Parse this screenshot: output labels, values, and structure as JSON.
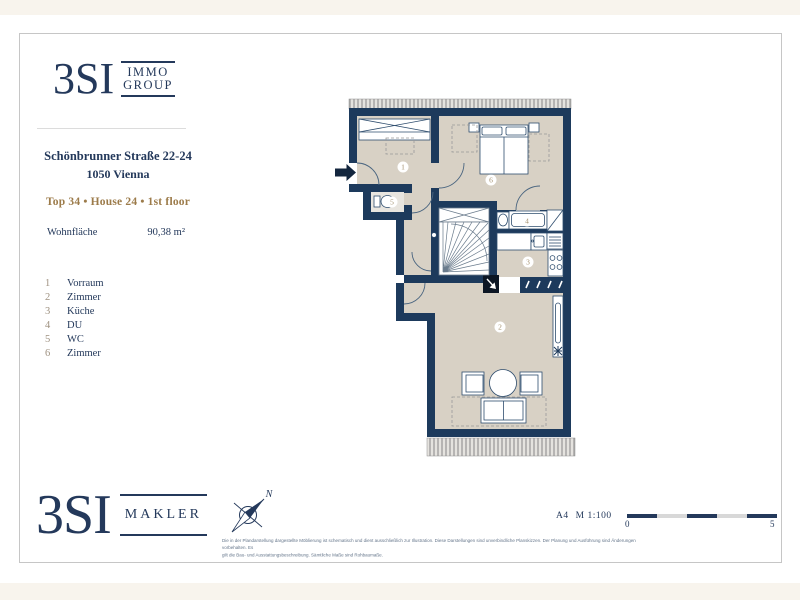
{
  "brand_top": {
    "name": "3SI",
    "tag_line1": "IMMO",
    "tag_line2": "GROUP"
  },
  "property": {
    "address_line1": "Schönbrunner Straße 22-24",
    "address_line2": "1050 Vienna",
    "unit_line": "Top 34 • House 24 • 1st floor",
    "area_label": "Wohnfläche",
    "area_value": "90,38 m²"
  },
  "legend": {
    "items": [
      {
        "num": "1",
        "label": "Vorraum"
      },
      {
        "num": "2",
        "label": "Zimmer"
      },
      {
        "num": "3",
        "label": "Küche"
      },
      {
        "num": "4",
        "label": "DU"
      },
      {
        "num": "5",
        "label": "WC"
      },
      {
        "num": "6",
        "label": "Zimmer"
      }
    ]
  },
  "plan": {
    "room_labels": [
      "1",
      "2",
      "3",
      "4",
      "5",
      "6"
    ],
    "colors": {
      "wall": "#1d3a5c",
      "floor": "#d8d1c5",
      "wet_floor": "#e8e5df"
    }
  },
  "brand_bottom": {
    "name": "3SI",
    "tag": "MAKLER"
  },
  "compass": {
    "north": "N"
  },
  "scale": {
    "sheet": "A4",
    "ratio": "M 1:100",
    "start_label": "0",
    "end_label": "5"
  },
  "disclaimer": {
    "line1": "Die in der Plandarstellung dargestellte Möblierung ist schematisch und dient ausschließlich zur Illustration. Diese Darstellungen sind unverbindliche Planskizzen. Der Planung und Ausführung sind Änderungen vorbehalten. Es",
    "line2": "gilt die Bau- und Ausstattungsbeschreibung. Sämtliche Maße sind Rohbaumaße."
  }
}
